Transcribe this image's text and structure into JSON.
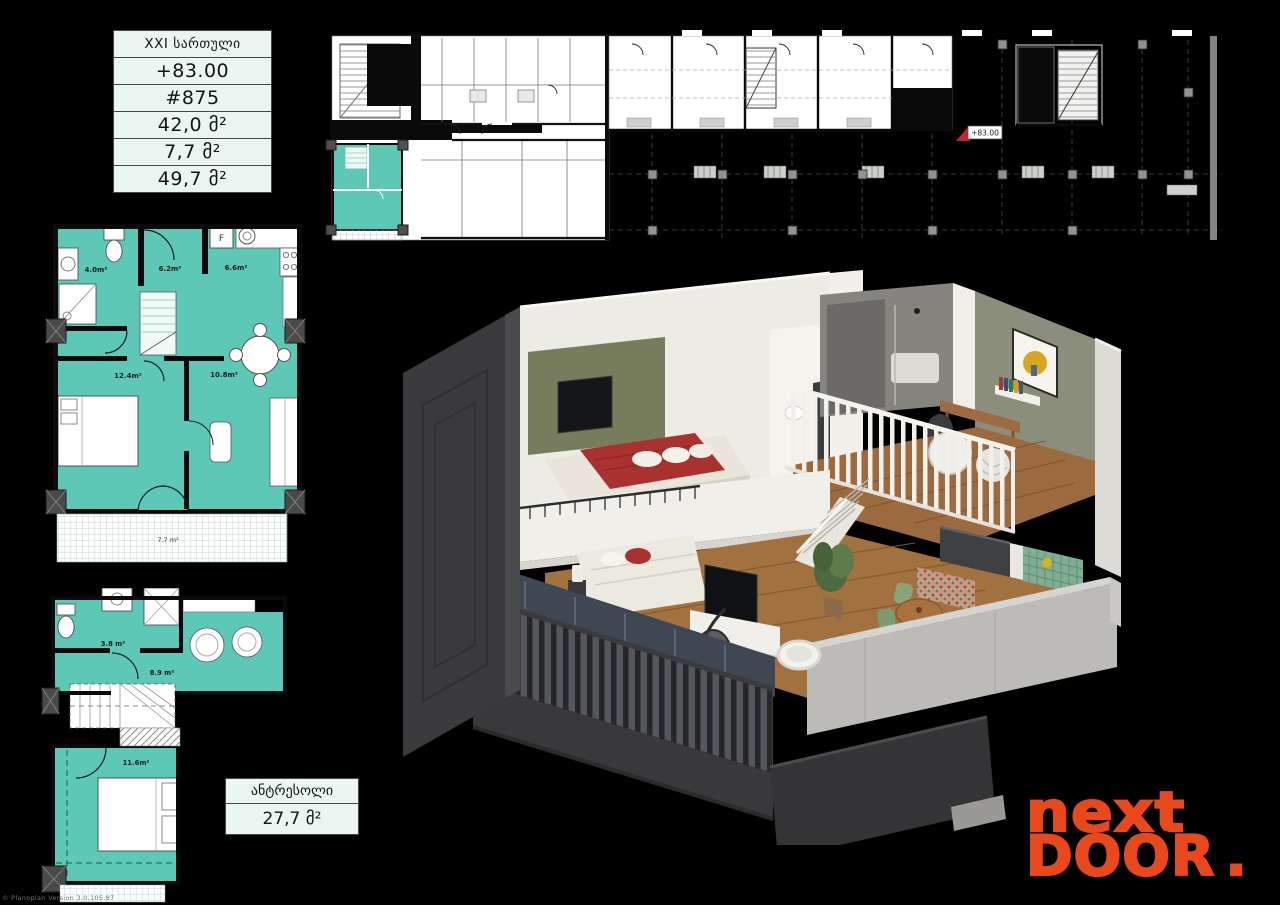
{
  "colors": {
    "background": "#000000",
    "teal": "#5ec8b7",
    "card_bg": "#eaf6f2",
    "logo_orange": "#e8481c",
    "wall_black": "#0a0a0a"
  },
  "unit_card": {
    "floor_label": "XXI სართული",
    "elevation": "+83.00",
    "unit_number": "#875",
    "inner_area": "42,0 მ²",
    "summer_area": "7,7 მ²",
    "total_area": "49,7 მ²"
  },
  "mezzanine_card": {
    "title": "ანტრესოლი",
    "area": "27,7 მ²"
  },
  "site_plan": {
    "elevation_marker": "+83.00"
  },
  "floor_plan_main": {
    "bathroom": "4.0m²",
    "hall": "6.2m²",
    "kitchen": "6.6m²",
    "bedroom": "12.4m²",
    "living": "10.8m²",
    "balcony": "7.7 m²",
    "fridge": "F"
  },
  "floor_plan_mezzanine": {
    "bathroom": "3.8 m²",
    "hall": "8.9 m²",
    "bedroom": "11.6m²"
  },
  "logo": {
    "line1": "next",
    "line2": "door",
    "dot": "."
  },
  "watermark": "© Planoplan Version 3.0.105.87"
}
